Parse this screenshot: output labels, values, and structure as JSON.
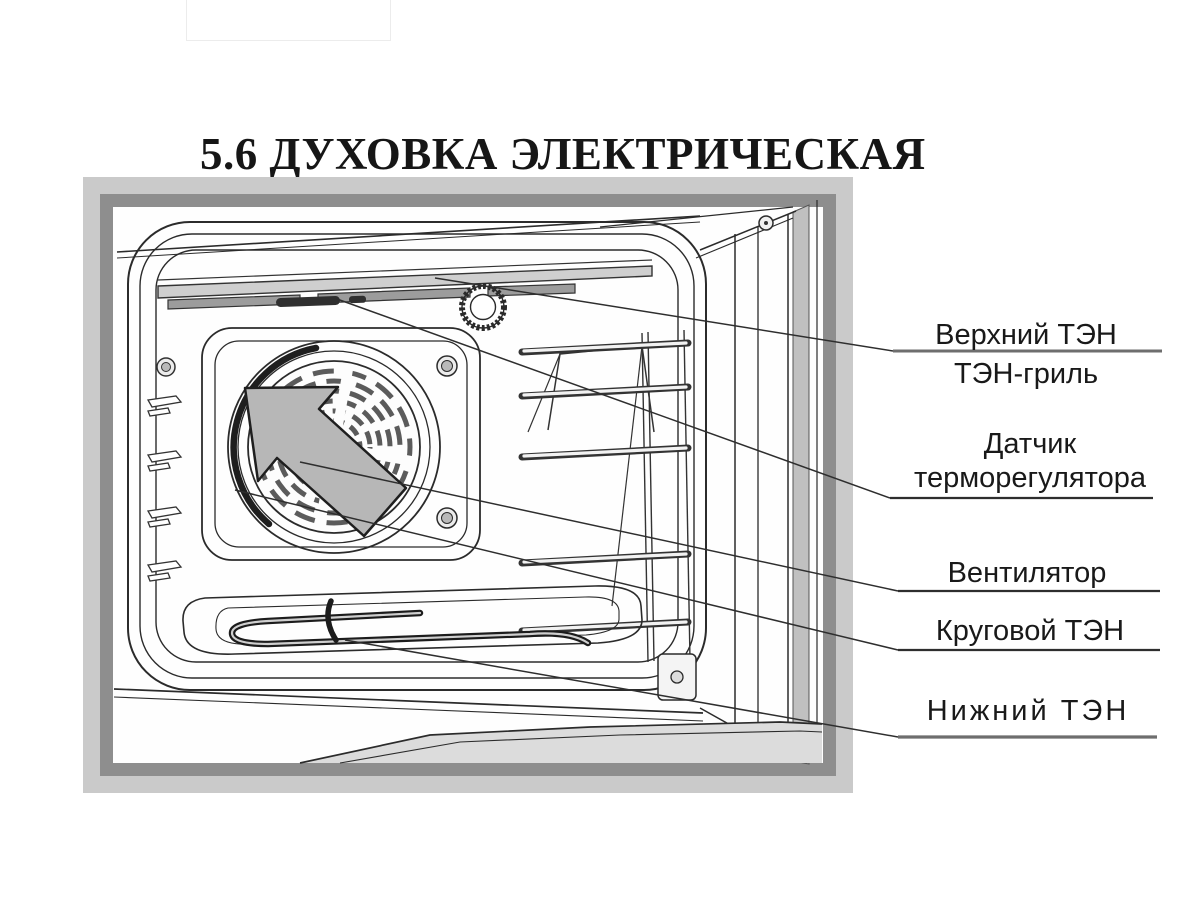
{
  "page": {
    "title": "5.6 ДУХОВКА ЭЛЕКТРИЧЕСКАЯ"
  },
  "figure": {
    "type": "technical-diagram",
    "subject": "electric oven cavity components",
    "callouts": [
      {
        "id": "upper-heater",
        "lines": [
          "Верхний ТЭН",
          "ТЭН-гриль"
        ]
      },
      {
        "id": "thermostat-sensor",
        "lines": [
          "Датчик",
          "терморегулятора"
        ]
      },
      {
        "id": "fan",
        "lines": [
          "Вентилятор"
        ]
      },
      {
        "id": "circular-heater",
        "lines": [
          "Круговой ТЭН"
        ]
      },
      {
        "id": "lower-heater",
        "lines": [
          "Нижний ТЭН"
        ]
      }
    ]
  },
  "colors": {
    "frame_light": "#cacaca",
    "frame_dark": "#8e8e8e",
    "drawing_line": "#2b2b2b",
    "arrow_fill": "#b7b7b7",
    "text": "#191919"
  }
}
